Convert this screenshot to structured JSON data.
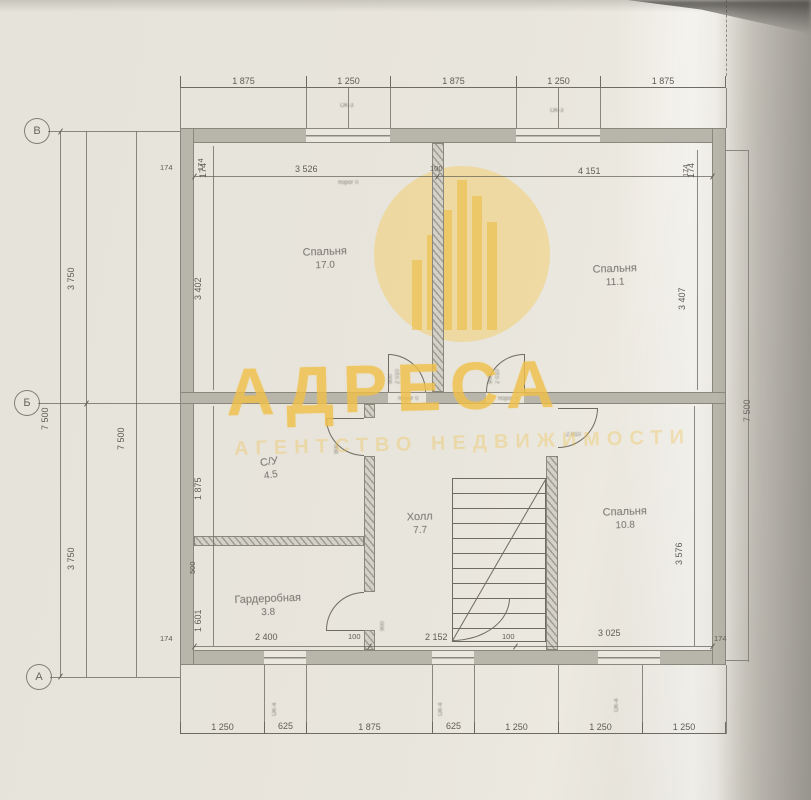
{
  "watermark": {
    "brand": "АДРЕСА",
    "tagline": "АГЕНТСТВО НЕДВИЖИМОСТИ",
    "color": "#f0c14a"
  },
  "axes": {
    "top": "В",
    "middle": "Б",
    "bottom": "А"
  },
  "rooms": [
    {
      "name": "Спальня",
      "area": "17.0"
    },
    {
      "name": "Спальня",
      "area": "11.1"
    },
    {
      "name": "С/У",
      "area": "4.5"
    },
    {
      "name": "Гардеробная",
      "area": "3.8"
    },
    {
      "name": "Холл",
      "area": "7.7"
    },
    {
      "name": "Спальня",
      "area": "10.8"
    }
  ],
  "dims": {
    "top_outer": [
      "1 875",
      "1 250",
      "1 875",
      "1 250",
      "1 875"
    ],
    "top_inner": [
      "174",
      "3 526",
      "100",
      "4 151",
      "174"
    ],
    "bottom_inner": [
      "174",
      "2 400",
      "100",
      "2 152",
      "100",
      "3 025",
      "174"
    ],
    "bottom_outer": [
      "1 250",
      "625",
      "1 875",
      "625",
      "1 250",
      "1 250",
      "1 250"
    ],
    "left_total_a": "7 500",
    "left_total_b": "7 500",
    "left_upper": "3 750",
    "left_lower": "3 750",
    "right_total": "7 500",
    "room_left_top": "3 402",
    "room_left_wc": "1 875",
    "room_left_gap": "500",
    "room_left_ward": "1 601",
    "room_right_top": "3 407",
    "room_right_bottom": "3 576",
    "wall_thickness": "174"
  },
  "annotations": {
    "threshold1": "порог 0",
    "threshold2": "порог 0",
    "door_w": "900",
    "door_h": "2 010",
    "window_top_label": "ОК-3",
    "window_bottom_label": "ОК-4"
  }
}
